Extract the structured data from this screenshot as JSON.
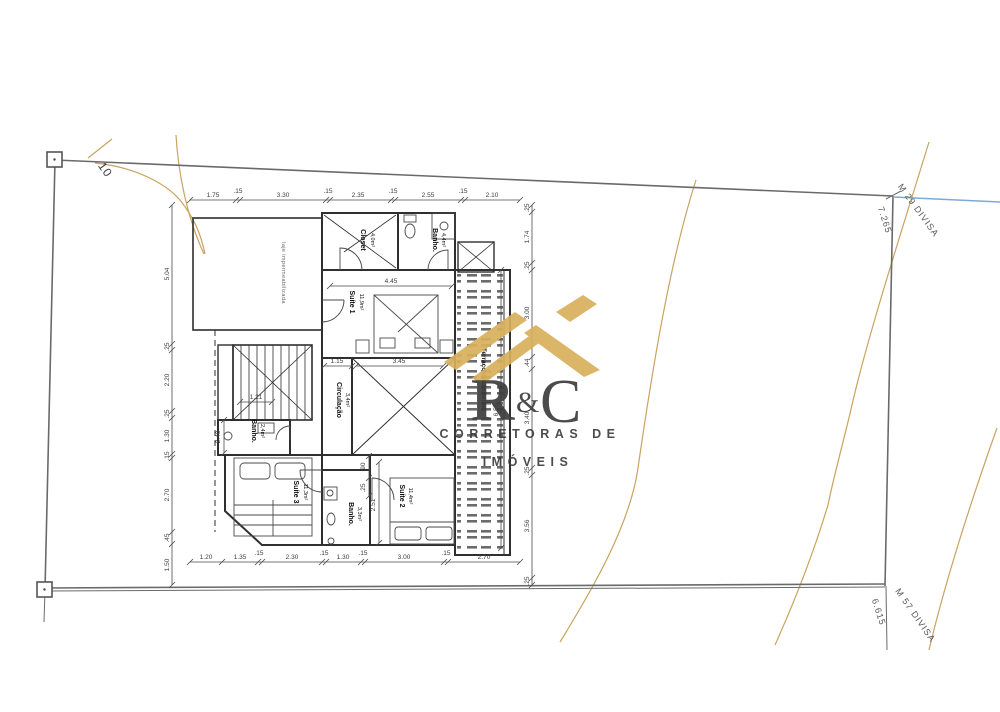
{
  "site": {
    "contour_label": "10",
    "boundary_labels": {
      "top_right_name": "M 29 DIVISA",
      "top_right_length": "7.265",
      "bottom_right_name": "M 57 DIVISA",
      "bottom_right_length": "6.615"
    }
  },
  "plan": {
    "rooms": {
      "laje": {
        "name": "laje impermeabilizada"
      },
      "closet": {
        "name": "Closet",
        "area": "4,0m²"
      },
      "bath1": {
        "name": "Banho.",
        "area": "4,4m²"
      },
      "suite1": {
        "name": "Suíte 1",
        "area": "11,9m²"
      },
      "circulacao": {
        "name": "Circulação",
        "area": "3,4m²"
      },
      "bath2": {
        "name": "Banho.",
        "area": "2,4m²"
      },
      "suite3": {
        "name": "Suíte 3",
        "area": "11,3m²"
      },
      "bath3": {
        "name": "Banho.",
        "area": "3,3m²"
      },
      "suite2": {
        "name": "Suíte 2",
        "area": "11,4m²"
      },
      "terrace": {
        "name": "Terraço descoberto"
      }
    },
    "dims": {
      "top": [
        "1.75",
        ".15",
        "3.30",
        ".15",
        "2.35",
        ".15",
        "2.55",
        ".15",
        "2.10"
      ],
      "bottom": [
        "1.20",
        "1.35",
        ".15",
        "2.30",
        ".15",
        "1.30",
        ".15",
        "3.00",
        ".15",
        "2.70"
      ],
      "left": [
        "5.04",
        ".25",
        "2.20",
        ".25",
        "1.30",
        ".15",
        "2.70",
        ".45",
        "1.50"
      ],
      "right": [
        ".25",
        "1.74",
        ".25",
        "3.00",
        ".44",
        "3.40",
        ".25",
        "3.56",
        ".25"
      ],
      "interior": {
        "suite1_width": "4.45",
        "suite1_inner": "3.45",
        "circ_width": "1.15",
        "stairs": "1.21",
        "bath2_depth": "2.40",
        "suite2_depth": "2.51",
        "suite2_a": ".90",
        "suite2_b": ".25",
        "terrace_depth": "6.55"
      }
    }
  },
  "watermark": {
    "letter_r": "R",
    "ampersand": "&",
    "letter_c": "C",
    "line1": "CORRETORAS DE",
    "line2": "IMÓVEIS"
  },
  "colors": {
    "wall": "#3a3a3a",
    "dimension": "#4a4a4a",
    "contour": "#c9a35f",
    "boundary_blue": "#7fa8d9",
    "logo_gold": "#d9b05c",
    "logo_gray": "#8a8c8e",
    "logo_dark": "#5f6163"
  }
}
